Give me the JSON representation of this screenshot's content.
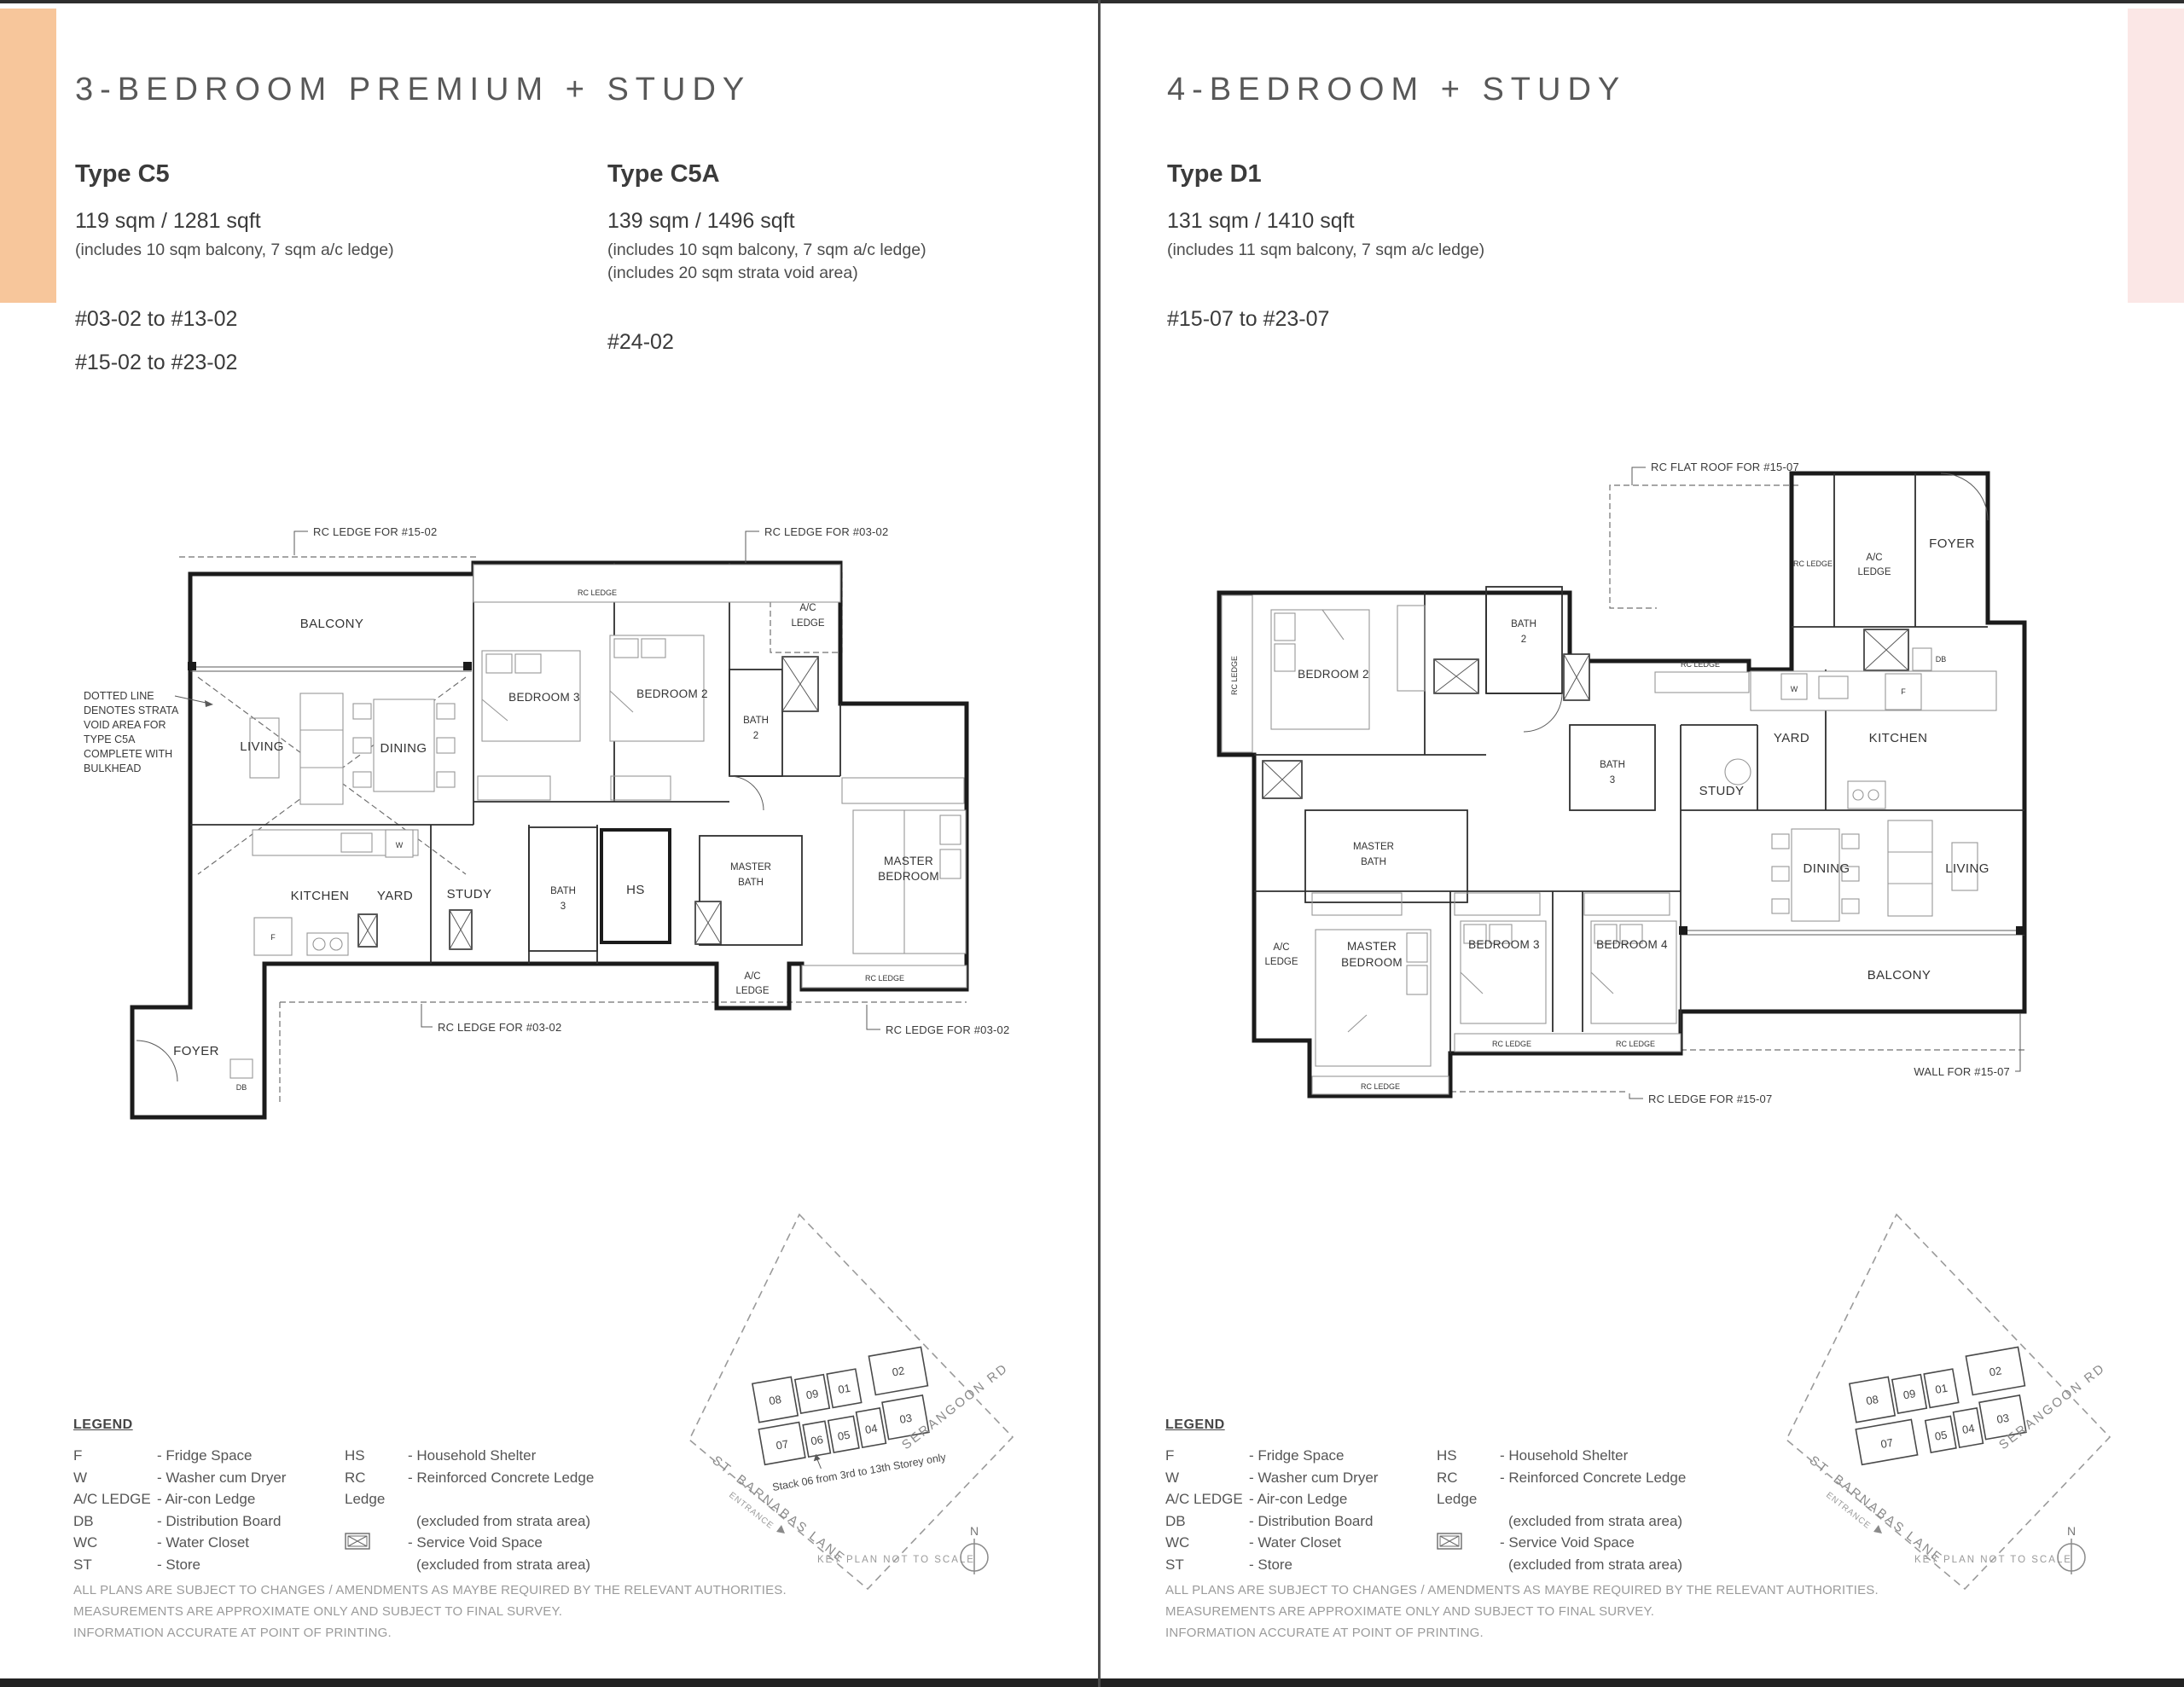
{
  "pages": {
    "left": {
      "title": "3-BEDROOM PREMIUM + STUDY",
      "types": [
        {
          "name": "Type C5",
          "area": "119 sqm / 1281 sqft",
          "note1": "(includes 10 sqm balcony, 7 sqm a/c ledge)",
          "note2": "",
          "units1": "#03-02 to #13-02",
          "units2": "#15-02 to #23-02"
        },
        {
          "name": "Type C5A",
          "area": "139 sqm / 1496 sqft",
          "note1": "(includes 10 sqm balcony, 7 sqm a/c ledge)",
          "note2": "(includes 20 sqm strata void area)",
          "units1": "#24-02",
          "units2": ""
        }
      ]
    },
    "right": {
      "title": "4-BEDROOM + STUDY",
      "types": [
        {
          "name": "Type D1",
          "area": "131 sqm / 1410 sqft",
          "note1": "(includes 11 sqm balcony, 7 sqm a/c ledge)",
          "note2": "",
          "units1": "#15-07 to #23-07",
          "units2": ""
        }
      ]
    }
  },
  "plan_c5": {
    "callout_top_left": "RC LEDGE FOR #15-02",
    "callout_top_right": "RC LEDGE FOR #03-02",
    "callout_bottom_mid": "RC LEDGE FOR #03-02",
    "callout_bottom_right": "RC LEDGE FOR #03-02",
    "balcony": "BALCONY",
    "living": "LIVING",
    "dining": "DINING",
    "bedroom3": "BEDROOM 3",
    "bedroom2": "BEDROOM 2",
    "bath2_1": "BATH",
    "bath2_2": "2",
    "ac_top_1": "A/C",
    "ac_top_2": "LEDGE",
    "rc_small_top": "RC LEDGE",
    "kitchen": "KITCHEN",
    "yard": "YARD",
    "study": "STUDY",
    "bath3_1": "BATH",
    "bath3_2": "3",
    "hs": "HS",
    "mbath_1": "MASTER",
    "mbath_2": "BATH",
    "mbed_1": "MASTER",
    "mbed_2": "BEDROOM",
    "ac_bot_1": "A/C",
    "ac_bot_2": "LEDGE",
    "rc_small_bot": "RC LEDGE",
    "foyer": "FOYER",
    "db": "DB",
    "w": "W",
    "f": "F",
    "strata_1": "DOTTED LINE",
    "strata_2": "DENOTES STRATA",
    "strata_3": "VOID AREA FOR",
    "strata_4": "TYPE C5A",
    "strata_5": "COMPLETE WITH",
    "strata_6": "BULKHEAD"
  },
  "plan_d1": {
    "callout_roof": "RC FLAT ROOF FOR #15-07",
    "callout_bottom": "RC LEDGE FOR #15-07",
    "callout_wall": "WALL FOR #15-07",
    "rc_top": "RC LEDGE",
    "ac_top_1": "A/C",
    "ac_top_2": "LEDGE",
    "foyer": "FOYER",
    "db": "DB",
    "w": "W",
    "f": "F",
    "yard": "YARD",
    "kitchen": "KITCHEN",
    "study": "STUDY",
    "bath2_1": "BATH",
    "bath2_2": "2",
    "bath3_1": "BATH",
    "bath3_2": "3",
    "bedroom2": "BEDROOM 2",
    "rc_left": "RC LEDGE",
    "rc_mid": "RC LEDGE",
    "mbath_1": "MASTER",
    "mbath_2": "BATH",
    "ac_left_1": "A/C",
    "ac_left_2": "LEDGE",
    "mbed_1": "MASTER",
    "mbed_2": "BEDROOM",
    "bedroom3": "BEDROOM 3",
    "bedroom4": "BEDROOM 4",
    "dining": "DINING",
    "living": "LIVING",
    "balcony": "BALCONY",
    "rc_b1": "RC LEDGE",
    "rc_b2": "RC LEDGE",
    "rc_b3": "RC LEDGE"
  },
  "legend": {
    "title": "LEGEND",
    "col1": [
      {
        "abbr": "F",
        "desc": "- Fridge Space"
      },
      {
        "abbr": "W",
        "desc": "- Washer cum Dryer"
      },
      {
        "abbr": "A/C LEDGE",
        "desc": "- Air-con Ledge"
      },
      {
        "abbr": "DB",
        "desc": "- Distribution Board"
      },
      {
        "abbr": "WC",
        "desc": "- Water Closet"
      },
      {
        "abbr": "ST",
        "desc": "- Store"
      }
    ],
    "col2": [
      {
        "abbr": "HS",
        "desc": "- Household Shelter"
      },
      {
        "abbr": "RC Ledge",
        "desc": "- Reinforced Concrete Ledge",
        "desc2": "(excluded from strata area)"
      },
      {
        "abbr": "",
        "desc": "- Service Void Space",
        "desc2": "(excluded from strata area)"
      }
    ]
  },
  "disclaimer": {
    "l1": "ALL PLANS ARE SUBJECT TO CHANGES / AMENDMENTS AS MAYBE REQUIRED BY THE RELEVANT AUTHORITIES.",
    "l2": "MEASUREMENTS ARE APPROXIMATE ONLY AND SUBJECT TO FINAL SURVEY.",
    "l3": "INFORMATION ACCURATE AT POINT OF PRINTING."
  },
  "keyplan": {
    "s08": "08",
    "s09": "09",
    "s01": "01",
    "s02": "02",
    "s07": "07",
    "s06": "06",
    "s05": "05",
    "s04": "04",
    "s03": "03",
    "street1": "ST. BARNABAS LANE",
    "street2": "SERANGOON RD",
    "entrance": "ENTRANCE",
    "note06": "Stack 06 from 3rd to 13th Storey only",
    "scale_note": "KEY PLAN NOT TO SCALE",
    "north": "N"
  },
  "colors": {
    "accent_left": "#F7C69B",
    "accent_right": "#FBE7E6",
    "stack_highlight_left": "#F5C291",
    "stack_highlight_right": "#F7DEDB"
  }
}
